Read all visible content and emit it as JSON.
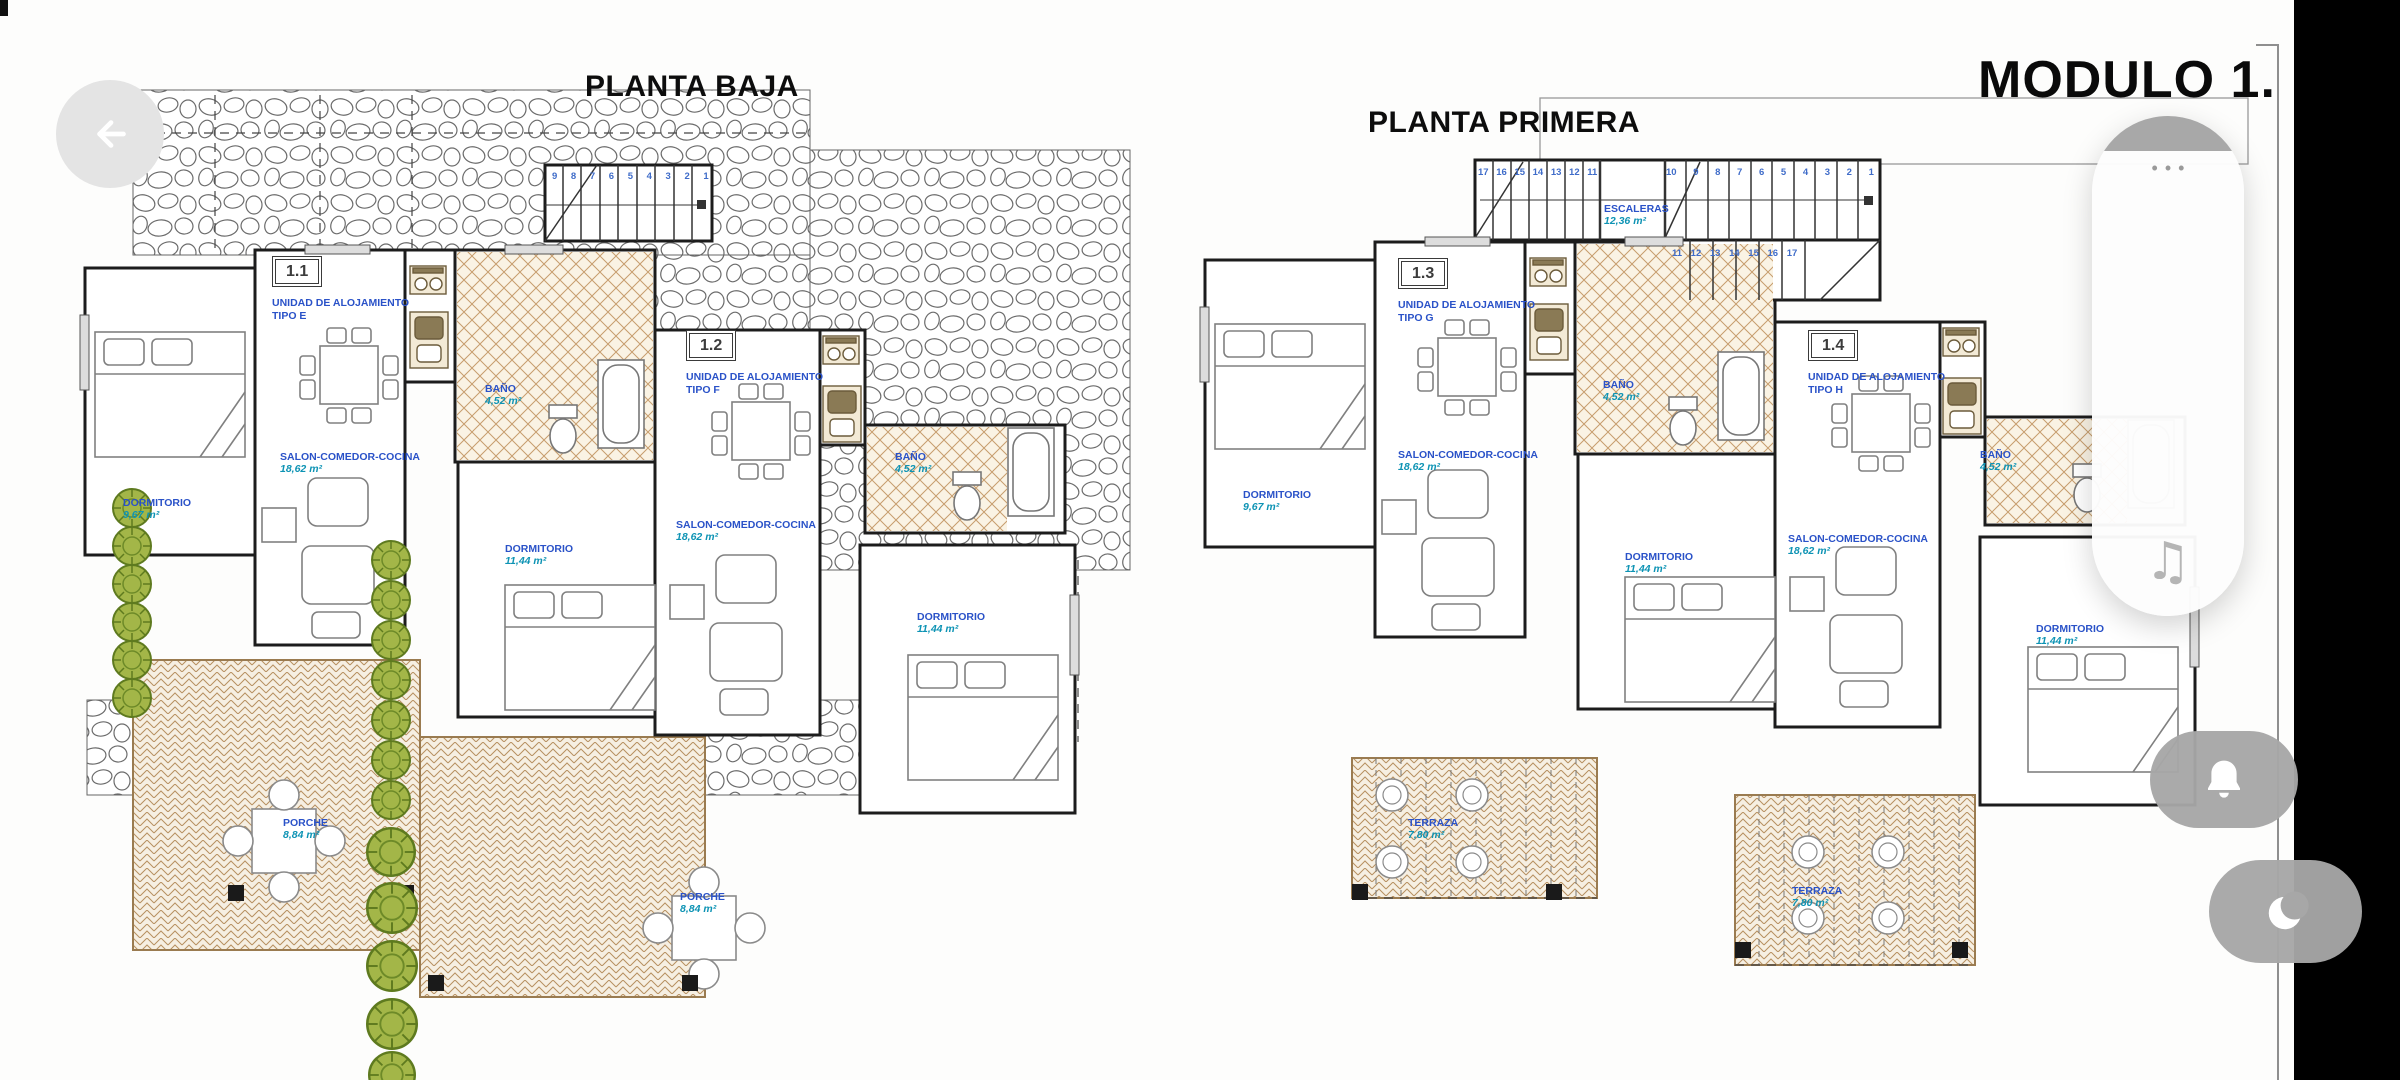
{
  "header": {
    "module_title": "MODULO 1."
  },
  "plans": {
    "baja": {
      "title": "PLANTA BAJA",
      "stair_numbers": "9 8 7 6 5 4 3 2 1",
      "units": [
        {
          "code": "1.1",
          "name": "UNIDAD DE ALOJAMIENTO",
          "tipo": "TIPO E"
        },
        {
          "code": "1.2",
          "name": "UNIDAD DE ALOJAMIENTO",
          "tipo": "TIPO F"
        }
      ],
      "rooms": [
        {
          "name": "DORMITORIO",
          "area": "9,67 m²"
        },
        {
          "name": "SALON-COMEDOR-COCINA",
          "area": "18,62 m²"
        },
        {
          "name": "BAÑO",
          "area": "4,52 m²"
        },
        {
          "name": "DORMITORIO",
          "area": "11,44 m²"
        },
        {
          "name": "SALON-COMEDOR-COCINA",
          "area": "18,62 m²"
        },
        {
          "name": "BAÑO",
          "area": "4,52 m²"
        },
        {
          "name": "DORMITORIO",
          "area": "11,44 m²"
        },
        {
          "name": "PORCHE",
          "area": "8,84 m²"
        },
        {
          "name": "PORCHE",
          "area": "8,84 m²"
        }
      ]
    },
    "primera": {
      "title": "PLANTA PRIMERA",
      "stairs": {
        "name": "ESCALERAS",
        "area": "12,36 m²",
        "numbers_top_left": "17 16 15 14 13 12 11",
        "numbers_top_right": "10 9 8 7 6 5 4 3 2 1",
        "numbers_bottom": "11 12 13 14 15 16 17"
      },
      "units": [
        {
          "code": "1.3",
          "name": "UNIDAD DE ALOJAMIENTO",
          "tipo": "TIPO G"
        },
        {
          "code": "1.4",
          "name": "UNIDAD DE ALOJAMIENTO",
          "tipo": "TIPO H"
        }
      ],
      "rooms": [
        {
          "name": "DORMITORIO",
          "area": "9,67 m²"
        },
        {
          "name": "SALON-COMEDOR-COCINA",
          "area": "18,62 m²"
        },
        {
          "name": "BAÑO",
          "area": "4,52 m²"
        },
        {
          "name": "DORMITORIO",
          "area": "11,44 m²"
        },
        {
          "name": "SALON-COMEDOR-COCINA",
          "area": "18,62 m²"
        },
        {
          "name": "BAÑO",
          "area": "4,52 m²"
        },
        {
          "name": "DORMITORIO",
          "area": "11,44 m²"
        },
        {
          "name": "TERRAZA",
          "area": "7,80 m²"
        },
        {
          "name": "TERRAZA",
          "area": "7,80 m²"
        }
      ]
    }
  },
  "controls": {
    "back_icon": "left-arrow",
    "panel": {
      "more_glyph": "•••",
      "music_glyph": "♫"
    },
    "bell_icon": "bell",
    "moon_icon": "moon"
  },
  "colors": {
    "label_blue": "#2a52c8",
    "area_teal": "#0d93b4",
    "button_gray": "#a7a7a7",
    "sidebar_black": "#000000"
  }
}
